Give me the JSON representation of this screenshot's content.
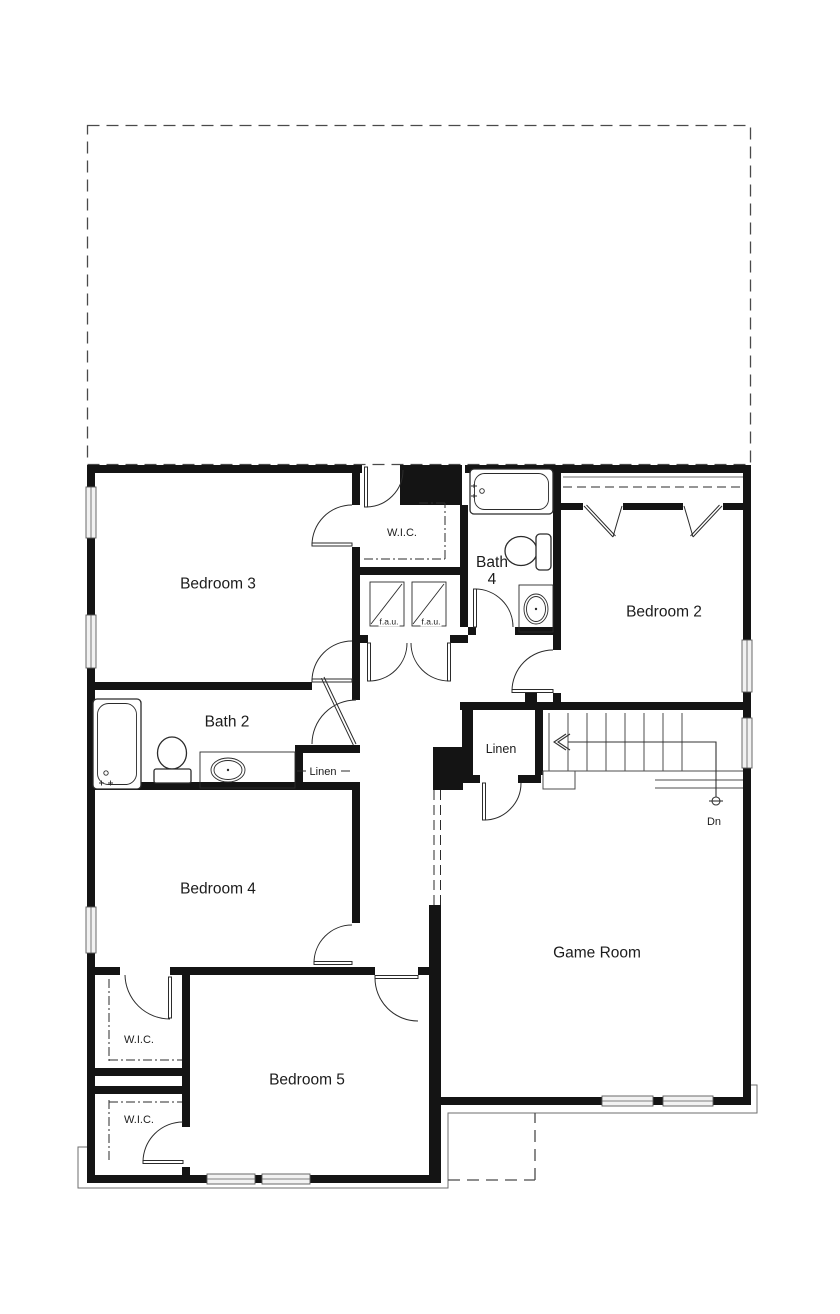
{
  "plan": {
    "rooms": {
      "bedroom3": "Bedroom 3",
      "bedroom2": "Bedroom 2",
      "bedroom4": "Bedroom 4",
      "bedroom5": "Bedroom 5",
      "game_room": "Game Room",
      "bath2": "Bath 2",
      "bath4_line1": "Bath",
      "bath4_line2": "4"
    },
    "closets": {
      "wic_top": "W.I.C.",
      "wic_upper_left": "W.I.C.",
      "wic_lower_left": "W.I.C.",
      "linen_hall": "Linen",
      "linen_stairs": "Linen"
    },
    "annotations": {
      "fau_left": "f.a.u.",
      "fau_right": "f.a.u.",
      "stairs_down": "Dn"
    },
    "colors": {
      "wall": "#141414",
      "line": "#2b2b2b",
      "thin": "#6e6e6e",
      "dash": "#4a4a4a",
      "background": "#ffffff"
    }
  }
}
